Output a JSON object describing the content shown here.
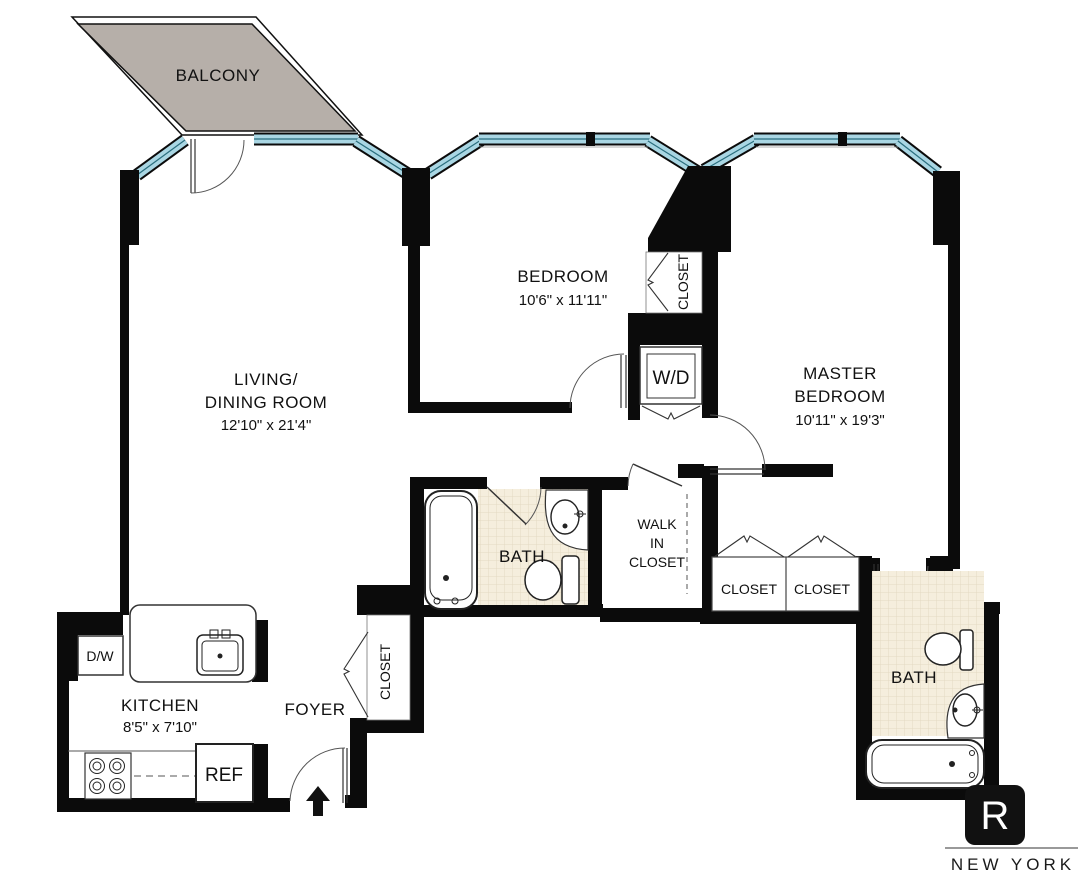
{
  "floor_plan": {
    "balcony": {
      "label": "BALCONY"
    },
    "living_dining": {
      "name_line1": "LIVING/",
      "name_line2": "DINING ROOM",
      "dimensions": "12'10\" x 21'4\""
    },
    "bedroom": {
      "name": "BEDROOM",
      "dimensions": "10'6\" x 11'11\""
    },
    "master_bedroom": {
      "name_line1": "MASTER",
      "name_line2": "BEDROOM",
      "dimensions": "10'11\" x 19'3\""
    },
    "kitchen": {
      "name": "KITCHEN",
      "dimensions": "8'5\" x 7'10\""
    },
    "foyer": {
      "name": "FOYER"
    },
    "hall_bath": {
      "name": "BATH"
    },
    "master_bath": {
      "name": "BATH"
    },
    "walk_in_closet": {
      "line1": "WALK",
      "line2": "IN",
      "line3": "CLOSET"
    },
    "bedroom_closet": {
      "name": "CLOSET"
    },
    "foyer_closet": {
      "name": "CLOSET"
    },
    "master_closet_left": {
      "name": "CLOSET"
    },
    "master_closet_right": {
      "name": "CLOSET"
    },
    "washer_dryer": {
      "name": "W/D"
    },
    "dishwasher": {
      "name": "D/W"
    },
    "refrigerator": {
      "name": "REF"
    }
  },
  "branding": {
    "logo_letter": "R",
    "wordmark": "NEW YORK"
  },
  "colors": {
    "wall": "#0b0b0b",
    "window_glass": "#a9d6e3",
    "window_mullion": "#2a6e7e",
    "balcony_fill": "#b6afa9",
    "bath_tile": "#f5eedd",
    "background": "#ffffff",
    "logo_bg": "#111111"
  }
}
